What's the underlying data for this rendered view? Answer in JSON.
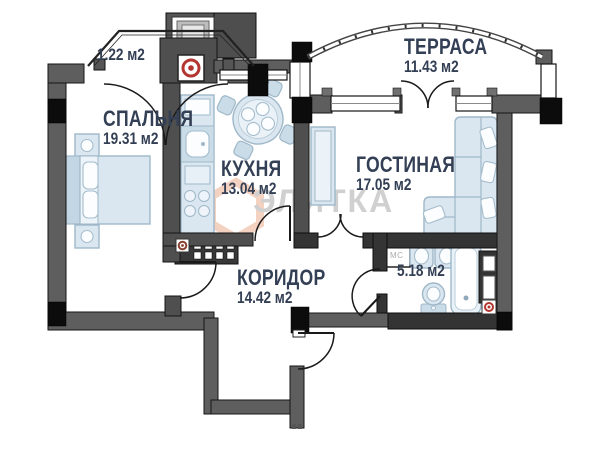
{
  "rooms": {
    "balcony": {
      "area": "1.22 м2"
    },
    "bedroom": {
      "name": "СПАЛЬНЯ",
      "area": "19.31 м2"
    },
    "kitchen": {
      "name": "КУХНЯ",
      "area": "13.04 м2"
    },
    "terrace": {
      "name": "ТЕРРАСА",
      "area": "11.43 м2"
    },
    "living": {
      "name": "ГОСТИНАЯ",
      "area": "17.05 м2"
    },
    "corridor": {
      "name": "КОРИДОР",
      "area": "14.42 м2"
    },
    "bathroom": {
      "area": "5.18 м2"
    }
  },
  "labels": {
    "washing_machine": "МС"
  },
  "watermark": {
    "text": "ЭЛИТКА",
    "logo_color": "#f2c7b2",
    "text_color": "#c5c5c5"
  },
  "colors": {
    "wall": "#5e5e5e",
    "wall_dark": "#343434",
    "corner_block": "#0c0c0c",
    "furniture": "#dbe7f0",
    "furniture_outline": "#9fb8c9",
    "label_text": "#333f54",
    "vent_red": "#b33630",
    "vent_brown": "#8a4030"
  }
}
